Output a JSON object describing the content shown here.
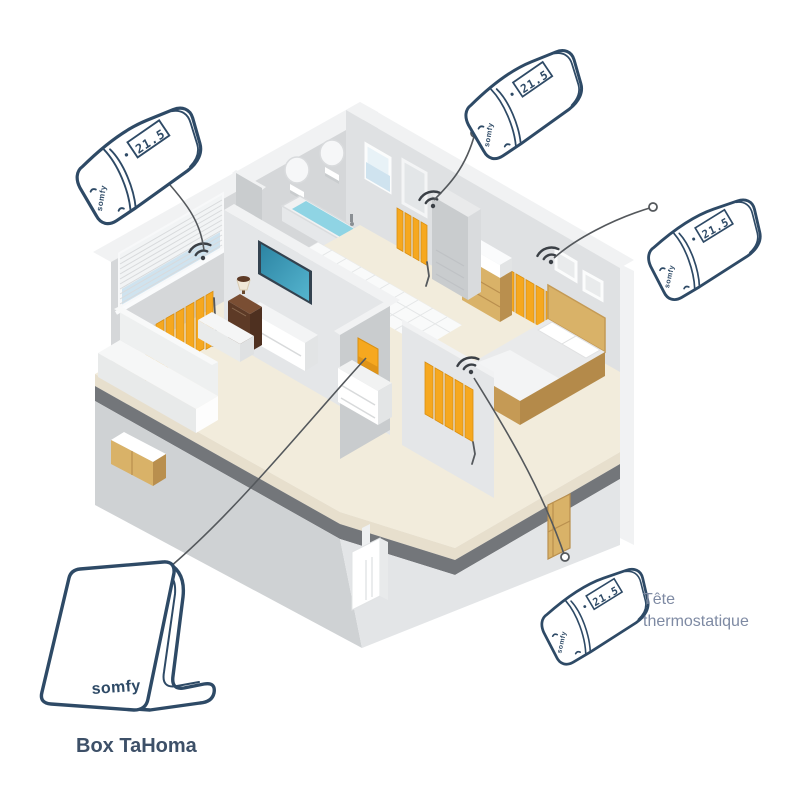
{
  "labels": {
    "hub": "Box TaHoma",
    "device_type": "Tête thermostatique",
    "device_type_line1": "Tête",
    "device_type_line2": "thermostatique"
  },
  "brand": {
    "name": "somfy"
  },
  "devices": [
    {
      "id": "head-top-left",
      "type": "thermostatic-head",
      "brand": "somfy",
      "display": "21.5",
      "linked_to": "radiator-living-room"
    },
    {
      "id": "head-top-center",
      "type": "thermostatic-head",
      "brand": "somfy",
      "display": "21.5",
      "linked_to": "radiator-bathroom"
    },
    {
      "id": "head-right",
      "type": "thermostatic-head",
      "brand": "somfy",
      "display": "21.5",
      "linked_to": "radiator-bedroom"
    },
    {
      "id": "head-bottom-right",
      "type": "thermostatic-head",
      "brand": "somfy",
      "display": "21.5",
      "linked_to": "radiator-hallway"
    },
    {
      "id": "tahoma-box",
      "type": "hub",
      "brand": "somfy",
      "label": "Box TaHoma",
      "linked_to": "hallway-wall-panel"
    }
  ],
  "house": {
    "rooms": [
      {
        "name": "living-room",
        "items": [
          "window-blinds",
          "radiator-with-wifi",
          "sofa",
          "ottoman",
          "tv",
          "tv-stand",
          "cabinet",
          "lamp"
        ]
      },
      {
        "name": "bathroom",
        "items": [
          "bathtub",
          "round-mirrors",
          "window",
          "mirror-door",
          "towel-radiator-with-wifi",
          "tiled-floor"
        ]
      },
      {
        "name": "bedroom",
        "items": [
          "bed",
          "pillows",
          "wall-frames",
          "radiator-with-wifi",
          "dresser"
        ]
      },
      {
        "name": "hallway",
        "items": [
          "shelf-unit",
          "orange-panel",
          "radiator-with-wifi",
          "stair-block"
        ]
      },
      {
        "name": "basement",
        "items": [
          "cabinet",
          "boiler",
          "door"
        ]
      }
    ]
  },
  "colors": {
    "bg": "#ffffff",
    "navy": "#2E4A66",
    "radiator_orange": "#F6A81F",
    "radiator_edge": "#D98F12",
    "line_gray": "#54585C",
    "label_dark": "#3D5068",
    "label_blue": "#7E8AA3",
    "water": "#8FD4E4",
    "glass": "#CFE3EF",
    "wood": "#D9B268",
    "wood_dark": "#B98F4E",
    "brown": "#5D3A26",
    "screen_teal": "#2C84A3",
    "floor_cream": "#F2ECDC",
    "floor_band": "#E7DFCD",
    "slab_dark": "#73767A",
    "wall_a": "#D5D7D9",
    "wall_b": "#DFE1E3",
    "wall_c": "#C9CCCE",
    "wall_d": "#E4E6E8",
    "wall_top": "#F1F2F3",
    "lower_wall": "#CFD2D4",
    "lower_lit": "#E3E5E7",
    "tile": "#F9FAFA",
    "tile_line": "#E4E6E7"
  }
}
